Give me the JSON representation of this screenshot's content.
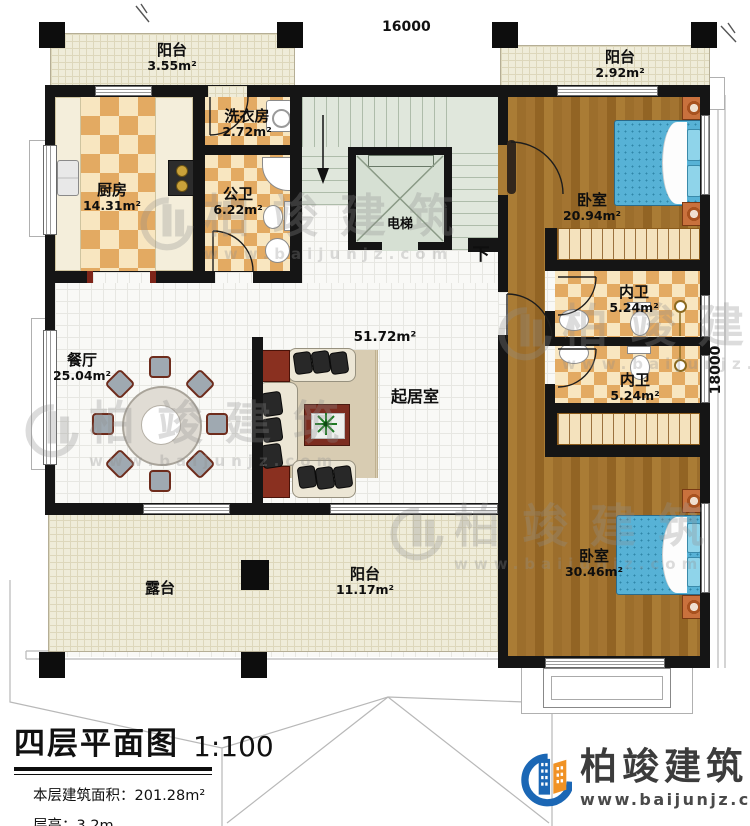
{
  "plan": {
    "dimensions": {
      "width": "16000",
      "height": "18000"
    },
    "rooms": {
      "balcony_top_left": {
        "name": "阳台",
        "area": "3.55m²"
      },
      "balcony_top_right": {
        "name": "阳台",
        "area": "2.92m²"
      },
      "kitchen": {
        "name": "厨房",
        "area": "14.31m²"
      },
      "laundry": {
        "name": "洗衣房",
        "area": "2.72m²"
      },
      "public_bath": {
        "name": "公卫",
        "area": "6.22m²"
      },
      "elevator": {
        "name": "电梯"
      },
      "stairs": {
        "down_label": "下"
      },
      "bedroom_top": {
        "name": "卧室",
        "area": "20.94m²"
      },
      "ensuite_1": {
        "name": "内卫",
        "area": "5.24m²"
      },
      "ensuite_2": {
        "name": "内卫",
        "area": "5.24m²"
      },
      "living": {
        "name": "起居室",
        "area": "51.72m²"
      },
      "dining": {
        "name": "餐厅",
        "area": "25.04m²"
      },
      "terrace": {
        "name": "露台"
      },
      "balcony_bottom": {
        "name": "阳台",
        "area": "11.17m²"
      },
      "bedroom_bottom": {
        "name": "卧室",
        "area": "30.46m²"
      }
    },
    "title": {
      "text": "四层平面图",
      "scale": "1:100"
    },
    "notes": {
      "floor_area": "本层建筑面积：201.28m²",
      "floor_height": "层高：3.2m"
    },
    "brand": {
      "name": "柏竣建筑",
      "url": "www.baijunjz.com",
      "colors": {
        "blue": "#1b67b5",
        "orange": "#f09225"
      }
    }
  }
}
